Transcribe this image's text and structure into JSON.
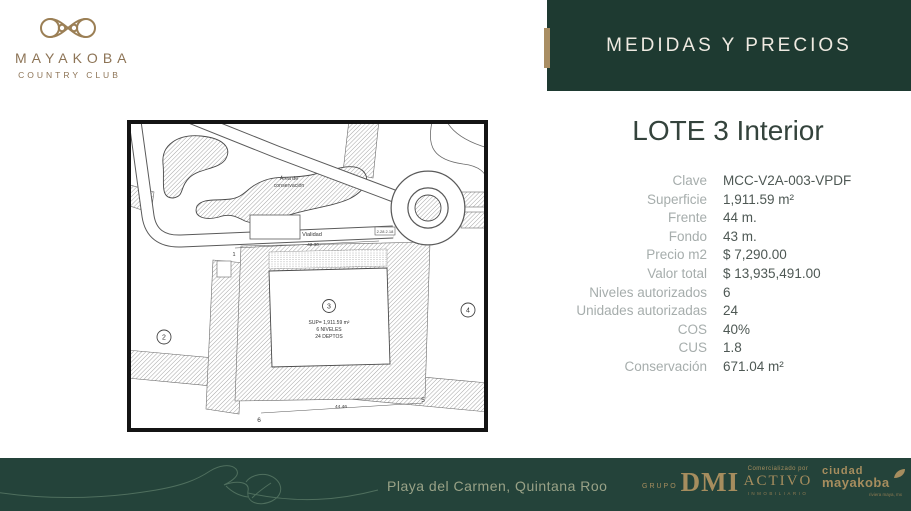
{
  "brand": {
    "name": "MAYAKOBA",
    "subtitle": "COUNTRY CLUB"
  },
  "header": {
    "title": "MEDIDAS Y PRECIOS"
  },
  "lot": {
    "title": "LOTE 3 Interior",
    "fields": [
      {
        "label": "Clave",
        "value": "MCC-V2A-003-VPDF"
      },
      {
        "label": "Superficie",
        "value": "1,911.59 m²"
      },
      {
        "label": "Frente",
        "value": "44 m."
      },
      {
        "label": "Fondo",
        "value": "43 m."
      },
      {
        "label": "Precio m2",
        "value": "$ 7,290.00"
      },
      {
        "label": "Valor total",
        "value": "$ 13,935,491.00"
      },
      {
        "label": "Niveles autorizados",
        "value": "6"
      },
      {
        "label": "Unidades autorizadas",
        "value": "24"
      },
      {
        "label": "COS",
        "value": "40%"
      },
      {
        "label": "CUS",
        "value": "1.8"
      },
      {
        "label": "Conservación",
        "value": "671.04 m²"
      }
    ]
  },
  "map": {
    "conservation_label_1": "Área  de",
    "conservation_label_2": "conservación",
    "road_label": "Vialidad",
    "dim_road": "42.30",
    "dim_bottom": "44.46",
    "small_dims": "2.28 2.18",
    "lot_left": "2",
    "lot_right": "4",
    "marker_1": "1",
    "marker_5": "5",
    "marker_6": "6",
    "lot_center": {
      "number": "3",
      "lines": [
        "SUP= 1,911.59 m²",
        "6 NIVELES",
        "24 DEPTOS"
      ]
    }
  },
  "footer": {
    "location": "Playa del Carmen, Quintana Roo",
    "logos": {
      "dmi": {
        "top": "GRUPO",
        "main": "DMI"
      },
      "activo": {
        "top": "Comercializado por",
        "main": "ACTIVO",
        "bottom": "INMOBILIARIO"
      },
      "ciudad": {
        "line1": "ciudad",
        "line2": "mayakoba",
        "line3": "riviera maya, mx"
      }
    }
  },
  "colors": {
    "header_green": "#1e3a31",
    "footer_green": "#24433a",
    "accent_gold": "#a98e63",
    "logo_gold": "#a68d5e",
    "brand_bronze": "#8d7456",
    "label_gray": "#a6adac",
    "value_gray": "#4e5854"
  }
}
